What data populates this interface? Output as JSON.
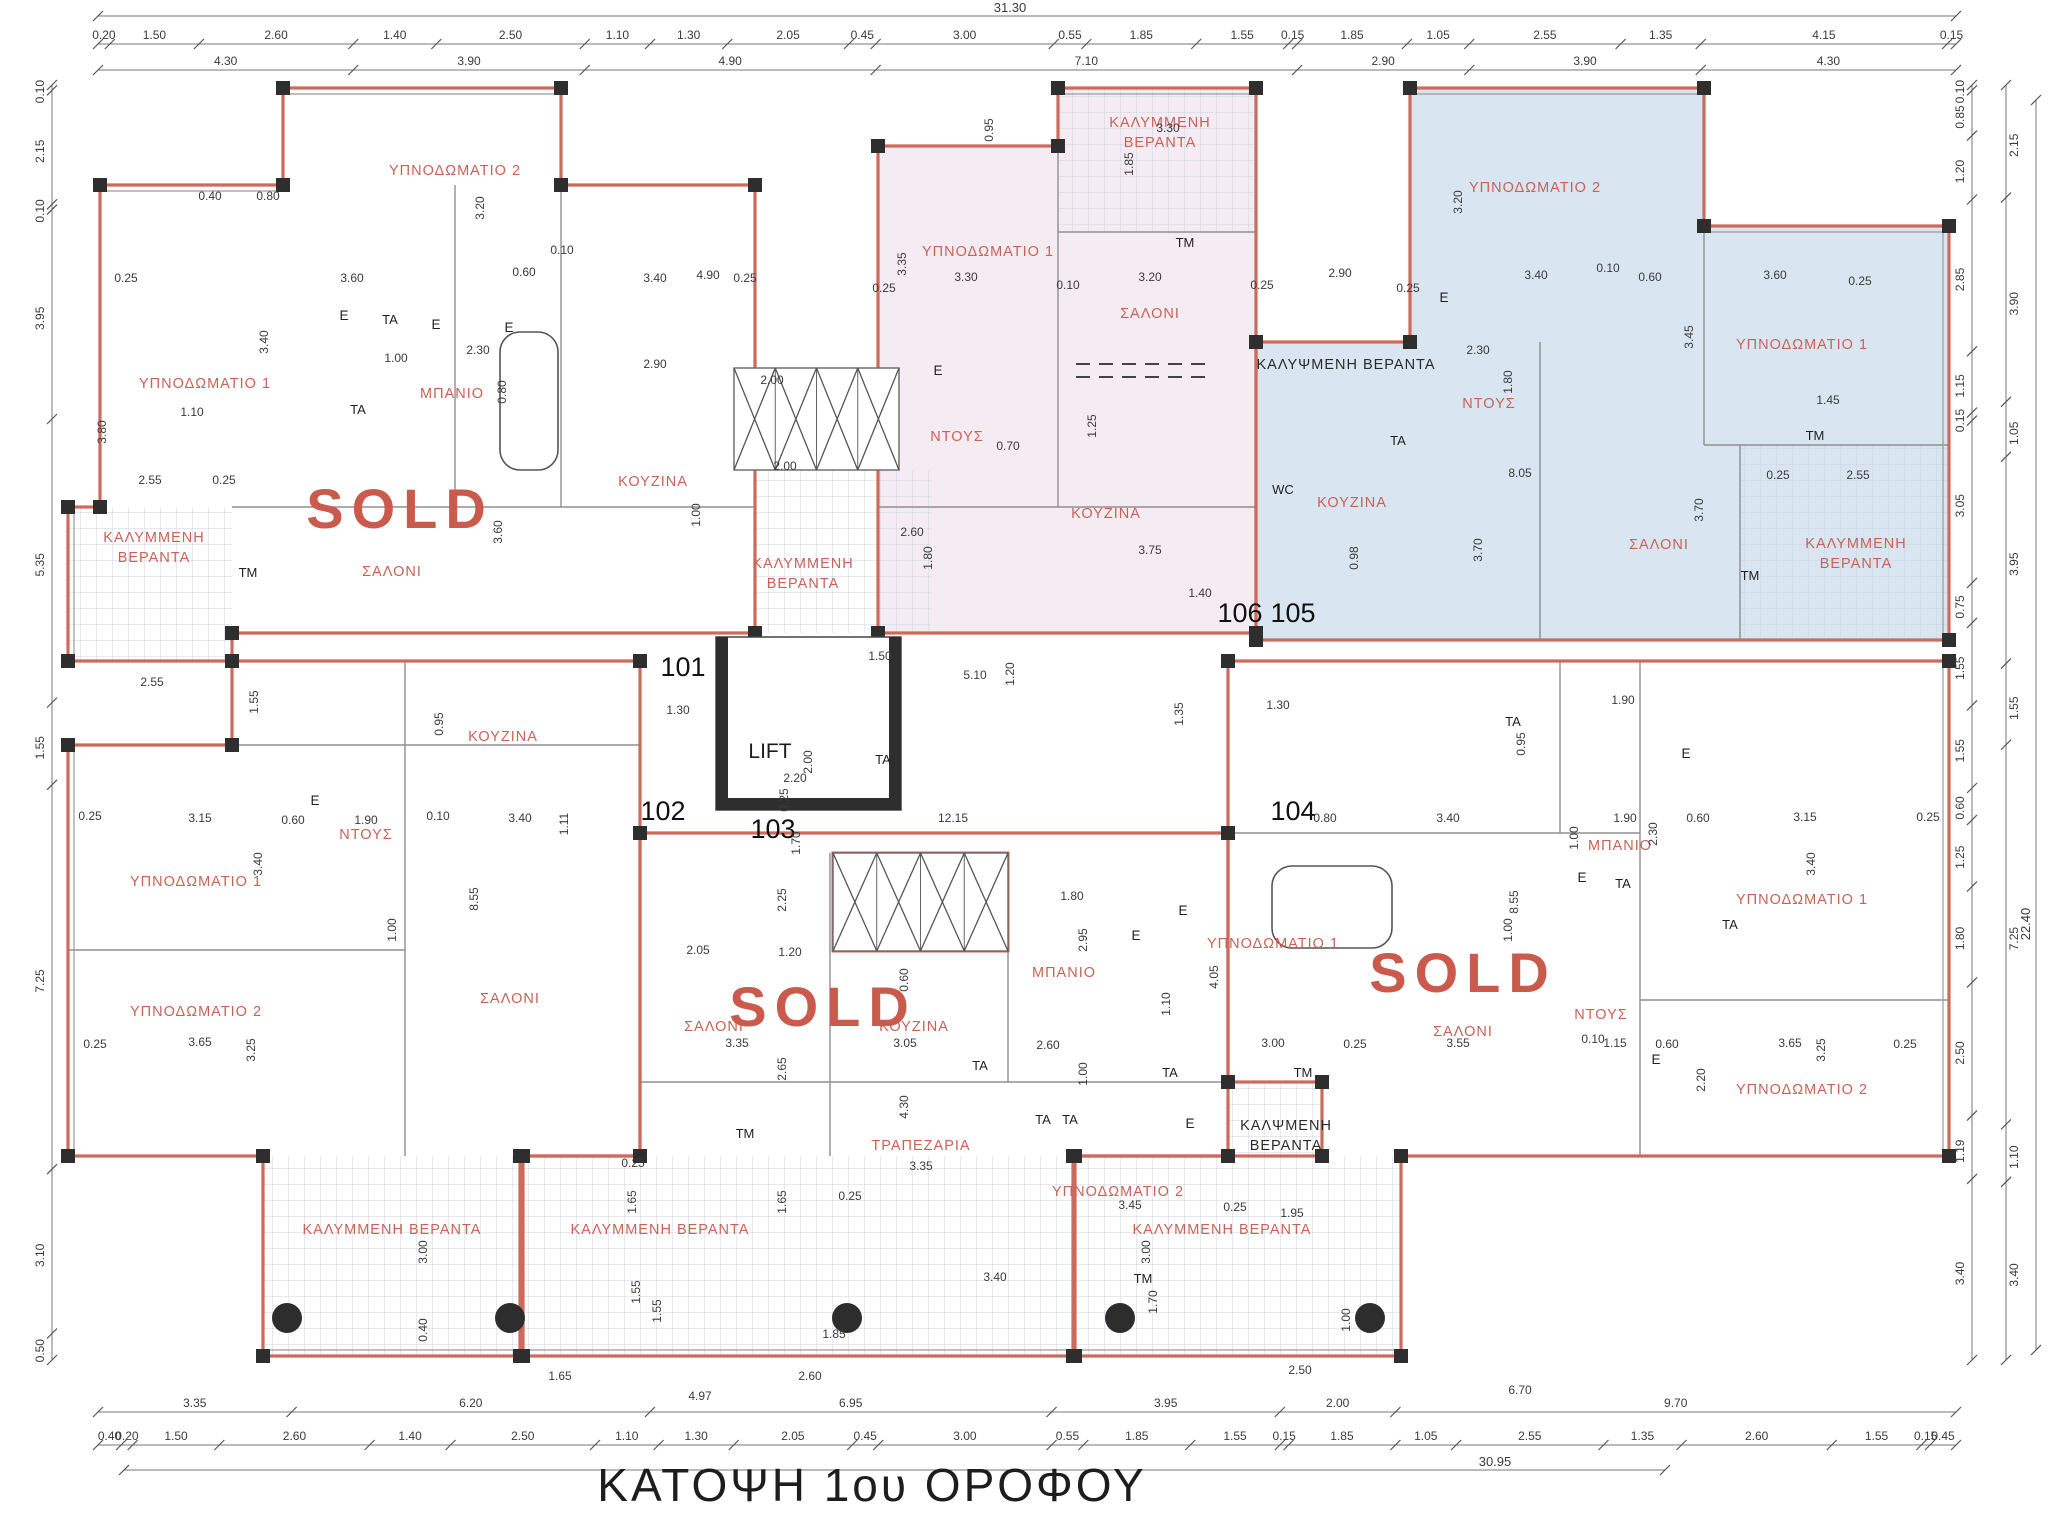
{
  "title": "ΚΑΤΟΨΗ 1ου ΟΡΟΦΟΥ",
  "sold_label": "SOLD",
  "lift_label": "LIFT",
  "colors": {
    "outline": "#cd6a5c",
    "room_text": "#c96256",
    "sold_text": "#c95a4c",
    "pink_fill": "#f5ecf3",
    "blue_fill": "#d9e6f2",
    "wall": "#2e2e2e",
    "dim_text": "#3a3a3a",
    "grid_line": "#ccd3de",
    "dark_text": "#2a2a2a"
  },
  "units": [
    {
      "number": "101",
      "x": 683,
      "y": 676
    },
    {
      "number": "102",
      "x": 663,
      "y": 820
    },
    {
      "number": "103",
      "x": 773,
      "y": 838
    },
    {
      "number": "104",
      "x": 1293,
      "y": 820
    },
    {
      "number": "105",
      "x": 1293,
      "y": 622
    },
    {
      "number": "106",
      "x": 1240,
      "y": 622
    }
  ],
  "sold_marks": [
    {
      "x": 400,
      "y": 528
    },
    {
      "x": 823,
      "y": 1026
    },
    {
      "x": 1463,
      "y": 992
    }
  ],
  "rooms": [
    {
      "t": [
        "ΥΠΝΟΔΩΜΑΤΙΟ 2"
      ],
      "x": 455,
      "y": 175
    },
    {
      "t": [
        "ΥΠΝΟΔΩΜΑΤΙΟ 1"
      ],
      "x": 205,
      "y": 388
    },
    {
      "t": [
        "ΚΑΛΥΜΜΕΝΗ",
        "ΒΕΡΑΝΤΑ"
      ],
      "x": 154,
      "y": 542
    },
    {
      "t": [
        "ΣΑΛΟΝΙ"
      ],
      "x": 392,
      "y": 576
    },
    {
      "t": [
        "ΜΠΑΝΙΟ"
      ],
      "x": 452,
      "y": 398
    },
    {
      "t": [
        "ΚΟΥΖΙΝΑ"
      ],
      "x": 653,
      "y": 486
    },
    {
      "t": [
        "ΚΑΛΥΜΜΕΝΗ",
        "ΒΕΡΑΝΤΑ"
      ],
      "x": 803,
      "y": 568
    },
    {
      "t": [
        "ΚΑΛΥΜΜΕΝΗ",
        "ΒΕΡΑΝΤΑ"
      ],
      "x": 1160,
      "y": 127
    },
    {
      "t": [
        "ΥΠΝΟΔΩΜΑΤΙΟ 1"
      ],
      "x": 988,
      "y": 256
    },
    {
      "t": [
        "ΣΑΛΟΝΙ"
      ],
      "x": 1150,
      "y": 318
    },
    {
      "t": [
        "ΝΤΟΥΣ"
      ],
      "x": 957,
      "y": 441
    },
    {
      "t": [
        "ΚΟΥΖΙΝΑ"
      ],
      "x": 1106,
      "y": 518
    },
    {
      "t": [
        "ΥΠΝΟΔΩΜΑΤΙΟ 2"
      ],
      "x": 1535,
      "y": 192
    },
    {
      "t": [
        "ΚΑΛΥΨΜΕΝΗ ΒΕΡΑΝΤΑ"
      ],
      "x": 1346,
      "y": 369,
      "c": "dark"
    },
    {
      "t": [
        "ΝΤΟΥΣ"
      ],
      "x": 1489,
      "y": 408
    },
    {
      "t": [
        "ΚΟΥΖΙΝΑ"
      ],
      "x": 1352,
      "y": 507
    },
    {
      "t": [
        "ΥΠΝΟΔΩΜΑΤΙΟ 1"
      ],
      "x": 1802,
      "y": 349
    },
    {
      "t": [
        "ΣΑΛΟΝΙ"
      ],
      "x": 1659,
      "y": 549
    },
    {
      "t": [
        "ΚΑΛΥΜΜΕΝΗ",
        "ΒΕΡΑΝΤΑ"
      ],
      "x": 1856,
      "y": 548
    },
    {
      "t": [
        "ΚΟΥΖΙΝΑ"
      ],
      "x": 503,
      "y": 741
    },
    {
      "t": [
        "ΥΠΝΟΔΩΜΑΤΙΟ 1"
      ],
      "x": 196,
      "y": 886
    },
    {
      "t": [
        "ΝΤΟΥΣ"
      ],
      "x": 366,
      "y": 839
    },
    {
      "t": [
        "ΥΠΝΟΔΩΜΑΤΙΟ 2"
      ],
      "x": 196,
      "y": 1016
    },
    {
      "t": [
        "ΣΑΛΟΝΙ"
      ],
      "x": 510,
      "y": 1003
    },
    {
      "t": [
        "ΚΑΛΥΜΜΕΝΗ ΒΕΡΑΝΤΑ"
      ],
      "x": 392,
      "y": 1234
    },
    {
      "t": [
        "ΣΑΛΟΝΙ"
      ],
      "x": 714,
      "y": 1031
    },
    {
      "t": [
        "ΚΟΥΖΙΝΑ"
      ],
      "x": 914,
      "y": 1031
    },
    {
      "t": [
        "ΜΠΑΝΙΟ"
      ],
      "x": 1064,
      "y": 977
    },
    {
      "t": [
        "ΤΡΑΠΕΖΑΡΙΑ"
      ],
      "x": 921,
      "y": 1150
    },
    {
      "t": [
        "ΥΠΝΟΔΩΜΑΤΙΟ 2"
      ],
      "x": 1118,
      "y": 1196
    },
    {
      "t": [
        "ΥΠΝΟΔΩΜΑΤΙΟ 1"
      ],
      "x": 1273,
      "y": 948
    },
    {
      "t": [
        "ΚΑΛΨΜΕΝΗ",
        "ΒΕΡΑΝΤΑ"
      ],
      "x": 1286,
      "y": 1130,
      "c": "dark"
    },
    {
      "t": [
        "ΚΑΛΥΜΜΕΝΗ ΒΕΡΑΝΤΑ"
      ],
      "x": 660,
      "y": 1234
    },
    {
      "t": [
        "ΚΑΛΥΜΜΕΝΗ ΒΕΡΑΝΤΑ"
      ],
      "x": 1222,
      "y": 1234
    },
    {
      "t": [
        "ΜΠΑΝΙΟ"
      ],
      "x": 1620,
      "y": 850
    },
    {
      "t": [
        "ΝΤΟΥΣ"
      ],
      "x": 1601,
      "y": 1019
    },
    {
      "t": [
        "ΥΠΝΟΔΩΜΑΤΙΟ 1"
      ],
      "x": 1802,
      "y": 904
    },
    {
      "t": [
        "ΥΠΝΟΔΩΜΑΤΙΟ 2"
      ],
      "x": 1802,
      "y": 1094
    },
    {
      "t": [
        "ΣΑΛΟΝΙ"
      ],
      "x": 1463,
      "y": 1036
    }
  ],
  "fixtures": [
    {
      "t": "TM",
      "x": 1185,
      "y": 247
    },
    {
      "t": "TM",
      "x": 1815,
      "y": 440
    },
    {
      "t": "TM",
      "x": 1750,
      "y": 580
    },
    {
      "t": "TM",
      "x": 248,
      "y": 577
    },
    {
      "t": "TM",
      "x": 745,
      "y": 1138
    },
    {
      "t": "TM",
      "x": 1303,
      "y": 1077
    },
    {
      "t": "TM",
      "x": 1143,
      "y": 1283
    },
    {
      "t": "TA",
      "x": 390,
      "y": 324
    },
    {
      "t": "TA",
      "x": 358,
      "y": 414
    },
    {
      "t": "TA",
      "x": 883,
      "y": 764
    },
    {
      "t": "TA",
      "x": 1398,
      "y": 445
    },
    {
      "t": "TA",
      "x": 1513,
      "y": 726
    },
    {
      "t": "TA",
      "x": 980,
      "y": 1070
    },
    {
      "t": "TA",
      "x": 1043,
      "y": 1124
    },
    {
      "t": "TA",
      "x": 1170,
      "y": 1077
    },
    {
      "t": "TA",
      "x": 1070,
      "y": 1124
    },
    {
      "t": "TA",
      "x": 1623,
      "y": 888
    },
    {
      "t": "TA",
      "x": 1730,
      "y": 929
    },
    {
      "t": "E",
      "x": 344,
      "y": 320
    },
    {
      "t": "E",
      "x": 436,
      "y": 329
    },
    {
      "t": "E",
      "x": 509,
      "y": 332
    },
    {
      "t": "E",
      "x": 938,
      "y": 375
    },
    {
      "t": "E",
      "x": 1444,
      "y": 302
    },
    {
      "t": "E",
      "x": 1686,
      "y": 758
    },
    {
      "t": "E",
      "x": 315,
      "y": 805
    },
    {
      "t": "E",
      "x": 1136,
      "y": 940
    },
    {
      "t": "E",
      "x": 1183,
      "y": 915
    },
    {
      "t": "E",
      "x": 1190,
      "y": 1128
    },
    {
      "t": "E",
      "x": 1582,
      "y": 882
    },
    {
      "t": "E",
      "x": 1656,
      "y": 1064
    },
    {
      "t": "WC",
      "x": 1283,
      "y": 494
    }
  ],
  "dims_inplan": [
    {
      "t": "0.40",
      "x": 210,
      "y": 200
    },
    {
      "t": "0.80",
      "x": 268,
      "y": 200
    },
    {
      "t": "0.25",
      "x": 126,
      "y": 282
    },
    {
      "t": "3.60",
      "x": 352,
      "y": 282
    },
    {
      "t": "0.60",
      "x": 524,
      "y": 276
    },
    {
      "t": "0.10",
      "x": 562,
      "y": 254
    },
    {
      "t": "3.40",
      "x": 655,
      "y": 282
    },
    {
      "t": "0.25",
      "x": 745,
      "y": 282
    },
    {
      "t": "3.20",
      "x": 484,
      "y": 208,
      "r": 90
    },
    {
      "t": "3.40",
      "x": 268,
      "y": 342,
      "r": 90
    },
    {
      "t": "1.10",
      "x": 192,
      "y": 416
    },
    {
      "t": "2.55",
      "x": 150,
      "y": 484
    },
    {
      "t": "0.25",
      "x": 224,
      "y": 484
    },
    {
      "t": "1.00",
      "x": 396,
      "y": 362
    },
    {
      "t": "2.30",
      "x": 478,
      "y": 354
    },
    {
      "t": "0.80",
      "x": 506,
      "y": 392,
      "r": 90
    },
    {
      "t": "3.80",
      "x": 106,
      "y": 432,
      "r": 90
    },
    {
      "t": "3.60",
      "x": 502,
      "y": 532,
      "r": 90
    },
    {
      "t": "4.90",
      "x": 708,
      "y": 279
    },
    {
      "t": "2.90",
      "x": 655,
      "y": 368
    },
    {
      "t": "2.00",
      "x": 772,
      "y": 384
    },
    {
      "t": "2.00",
      "x": 785,
      "y": 470
    },
    {
      "t": "1.00",
      "x": 700,
      "y": 515,
      "r": 90
    },
    {
      "t": "2.60",
      "x": 912,
      "y": 536
    },
    {
      "t": "1.80",
      "x": 932,
      "y": 558,
      "r": 90
    },
    {
      "t": "0.95",
      "x": 993,
      "y": 130,
      "r": 90
    },
    {
      "t": "3.30",
      "x": 1168,
      "y": 132
    },
    {
      "t": "1.85",
      "x": 1133,
      "y": 164,
      "r": 90
    },
    {
      "t": "3.35",
      "x": 906,
      "y": 264,
      "r": 90
    },
    {
      "t": "3.30",
      "x": 966,
      "y": 281
    },
    {
      "t": "0.10",
      "x": 1068,
      "y": 289
    },
    {
      "t": "3.20",
      "x": 1150,
      "y": 281
    },
    {
      "t": "0.25",
      "x": 884,
      "y": 292
    },
    {
      "t": "0.25",
      "x": 1262,
      "y": 289
    },
    {
      "t": "1.25",
      "x": 1096,
      "y": 426,
      "r": 90
    },
    {
      "t": "0.70",
      "x": 1008,
      "y": 450
    },
    {
      "t": "2.90",
      "x": 1340,
      "y": 277
    },
    {
      "t": "0.25",
      "x": 1408,
      "y": 292
    },
    {
      "t": "3.40",
      "x": 1536,
      "y": 279
    },
    {
      "t": "0.10",
      "x": 1608,
      "y": 272
    },
    {
      "t": "0.60",
      "x": 1650,
      "y": 281
    },
    {
      "t": "3.60",
      "x": 1775,
      "y": 279
    },
    {
      "t": "0.25",
      "x": 1860,
      "y": 285
    },
    {
      "t": "3.20",
      "x": 1462,
      "y": 202,
      "r": 90
    },
    {
      "t": "3.45",
      "x": 1693,
      "y": 337,
      "r": 90
    },
    {
      "t": "1.45",
      "x": 1828,
      "y": 404
    },
    {
      "t": "2.30",
      "x": 1478,
      "y": 354
    },
    {
      "t": "1.80",
      "x": 1512,
      "y": 382,
      "r": 90
    },
    {
      "t": "8.05",
      "x": 1520,
      "y": 477
    },
    {
      "t": "3.70",
      "x": 1482,
      "y": 550,
      "r": 90
    },
    {
      "t": "0.98",
      "x": 1358,
      "y": 558,
      "r": 90
    },
    {
      "t": "3.70",
      "x": 1703,
      "y": 510,
      "r": 90
    },
    {
      "t": "3.75",
      "x": 1150,
      "y": 554
    },
    {
      "t": "1.40",
      "x": 1200,
      "y": 597
    },
    {
      "t": "2.55",
      "x": 1858,
      "y": 479
    },
    {
      "t": "0.25",
      "x": 1778,
      "y": 479
    },
    {
      "t": "1.50",
      "x": 880,
      "y": 660
    },
    {
      "t": "5.10",
      "x": 975,
      "y": 679
    },
    {
      "t": "1.20",
      "x": 1014,
      "y": 674,
      "r": 90
    },
    {
      "t": "1.30",
      "x": 678,
      "y": 714
    },
    {
      "t": "12.15",
      "x": 953,
      "y": 822
    },
    {
      "t": "2.20",
      "x": 795,
      "y": 782
    },
    {
      "t": "2.00",
      "x": 812,
      "y": 762,
      "r": 90
    },
    {
      "t": "1.35",
      "x": 1183,
      "y": 714,
      "r": 90
    },
    {
      "t": "1.30",
      "x": 1278,
      "y": 709
    },
    {
      "t": "1.70",
      "x": 800,
      "y": 843,
      "r": 90
    },
    {
      "t": "0.25",
      "x": 788,
      "y": 800,
      "r": 90
    },
    {
      "t": "1.90",
      "x": 1623,
      "y": 704
    },
    {
      "t": "0.95",
      "x": 1525,
      "y": 744,
      "r": 90
    },
    {
      "t": "2.55",
      "x": 152,
      "y": 686
    },
    {
      "t": "1.55",
      "x": 258,
      "y": 702,
      "r": 90
    },
    {
      "t": "0.95",
      "x": 443,
      "y": 724,
      "r": 90
    },
    {
      "t": "0.25",
      "x": 90,
      "y": 820
    },
    {
      "t": "3.15",
      "x": 200,
      "y": 822
    },
    {
      "t": "0.60",
      "x": 293,
      "y": 824
    },
    {
      "t": "1.90",
      "x": 366,
      "y": 824
    },
    {
      "t": "0.10",
      "x": 438,
      "y": 820
    },
    {
      "t": "3.40",
      "x": 520,
      "y": 822
    },
    {
      "t": "1.11",
      "x": 568,
      "y": 824,
      "r": 90
    },
    {
      "t": "3.40",
      "x": 262,
      "y": 864,
      "r": 90
    },
    {
      "t": "8.55",
      "x": 478,
      "y": 899,
      "r": 90
    },
    {
      "t": "1.00",
      "x": 396,
      "y": 930,
      "r": 90
    },
    {
      "t": "3.65",
      "x": 200,
      "y": 1046
    },
    {
      "t": "0.25",
      "x": 95,
      "y": 1048
    },
    {
      "t": "3.25",
      "x": 255,
      "y": 1050,
      "r": 90
    },
    {
      "t": "2.05",
      "x": 698,
      "y": 954
    },
    {
      "t": "1.20",
      "x": 790,
      "y": 956
    },
    {
      "t": "2.25",
      "x": 786,
      "y": 900,
      "r": 90
    },
    {
      "t": "3.35",
      "x": 737,
      "y": 1047
    },
    {
      "t": "2.65",
      "x": 786,
      "y": 1069,
      "r": 90
    },
    {
      "t": "3.05",
      "x": 905,
      "y": 1047
    },
    {
      "t": "0.60",
      "x": 908,
      "y": 980,
      "r": 90
    },
    {
      "t": "1.80",
      "x": 1072,
      "y": 900
    },
    {
      "t": "2.95",
      "x": 1087,
      "y": 940,
      "r": 90
    },
    {
      "t": "2.60",
      "x": 1048,
      "y": 1049
    },
    {
      "t": "1.00",
      "x": 1087,
      "y": 1074,
      "r": 90
    },
    {
      "t": "4.30",
      "x": 908,
      "y": 1107,
      "r": 90
    },
    {
      "t": "3.35",
      "x": 921,
      "y": 1170
    },
    {
      "t": "1.65",
      "x": 786,
      "y": 1202,
      "r": 90
    },
    {
      "t": "0.25",
      "x": 850,
      "y": 1200
    },
    {
      "t": "4.05",
      "x": 1218,
      "y": 977,
      "r": 90
    },
    {
      "t": "1.10",
      "x": 1170,
      "y": 1004,
      "r": 90
    },
    {
      "t": "3.00",
      "x": 1273,
      "y": 1047
    },
    {
      "t": "0.25",
      "x": 1355,
      "y": 1048
    },
    {
      "t": "0.80",
      "x": 1325,
      "y": 822
    },
    {
      "t": "3.40",
      "x": 1448,
      "y": 822
    },
    {
      "t": "3.55",
      "x": 1458,
      "y": 1047
    },
    {
      "t": "8.55",
      "x": 1518,
      "y": 902,
      "r": 90
    },
    {
      "t": "1.00",
      "x": 1512,
      "y": 930,
      "r": 90
    },
    {
      "t": "1.95",
      "x": 1292,
      "y": 1217
    },
    {
      "t": "3.45",
      "x": 1130,
      "y": 1209
    },
    {
      "t": "0.25",
      "x": 1235,
      "y": 1211
    },
    {
      "t": "1.90",
      "x": 1625,
      "y": 822
    },
    {
      "t": "0.60",
      "x": 1698,
      "y": 822
    },
    {
      "t": "2.30",
      "x": 1657,
      "y": 834,
      "r": 90
    },
    {
      "t": "3.15",
      "x": 1805,
      "y": 821
    },
    {
      "t": "0.25",
      "x": 1928,
      "y": 821
    },
    {
      "t": "3.40",
      "x": 1815,
      "y": 864,
      "r": 90
    },
    {
      "t": "1.00",
      "x": 1578,
      "y": 838,
      "r": 90
    },
    {
      "t": "1.15",
      "x": 1615,
      "y": 1047
    },
    {
      "t": "0.60",
      "x": 1667,
      "y": 1048
    },
    {
      "t": "0.10",
      "x": 1593,
      "y": 1043
    },
    {
      "t": "2.20",
      "x": 1705,
      "y": 1080,
      "r": 90
    },
    {
      "t": "3.65",
      "x": 1790,
      "y": 1047
    },
    {
      "t": "3.25",
      "x": 1825,
      "y": 1050,
      "r": 90
    },
    {
      "t": "0.25",
      "x": 1905,
      "y": 1048
    },
    {
      "t": "1.65",
      "x": 560,
      "y": 1380
    },
    {
      "t": "2.60",
      "x": 810,
      "y": 1380
    },
    {
      "t": "4.97",
      "x": 700,
      "y": 1400
    },
    {
      "t": "2.50",
      "x": 1300,
      "y": 1374
    },
    {
      "t": "6.70",
      "x": 1520,
      "y": 1394
    },
    {
      "t": "3.00",
      "x": 427,
      "y": 1252,
      "r": 90
    },
    {
      "t": "0.40",
      "x": 427,
      "y": 1330,
      "r": 90
    },
    {
      "t": "1.55",
      "x": 640,
      "y": 1292,
      "r": 90
    },
    {
      "t": "1.65",
      "x": 636,
      "y": 1202,
      "r": 90
    },
    {
      "t": "0.25",
      "x": 633,
      "y": 1167
    },
    {
      "t": "3.00",
      "x": 1150,
      "y": 1252,
      "r": 90
    },
    {
      "t": "1.00",
      "x": 1350,
      "y": 1320,
      "r": 90
    },
    {
      "t": "3.40",
      "x": 995,
      "y": 1281
    },
    {
      "t": "1.85",
      "x": 834,
      "y": 1338
    },
    {
      "t": "1.55",
      "x": 661,
      "y": 1311,
      "r": 90
    },
    {
      "t": "1.70",
      "x": 1157,
      "y": 1302,
      "r": 90
    }
  ],
  "dim_chains": {
    "top_total": "31.30",
    "top_segments": [
      "0.20",
      "1.50",
      "2.60",
      "1.40",
      "2.50",
      "1.10",
      "1.30",
      "2.05",
      "0.45",
      "3.00",
      "0.55",
      "1.85",
      "1.55",
      "0.15",
      "1.85",
      "1.05",
      "2.55",
      "1.35",
      "4.15",
      "0.15"
    ],
    "top_groups": [
      "4.30",
      "3.90",
      "4.90",
      "7.10",
      "2.90",
      "3.90",
      "4.30"
    ],
    "bottom_groups": [
      "3.35",
      "6.20",
      "6.95",
      "3.95",
      "2.00",
      "9.70"
    ],
    "bottom_segments": [
      "0.40",
      "0.20",
      "1.50",
      "2.60",
      "1.40",
      "2.50",
      "1.10",
      "1.30",
      "2.05",
      "0.45",
      "3.00",
      "0.55",
      "1.85",
      "1.55",
      "0.15",
      "1.85",
      "1.05",
      "2.55",
      "1.35",
      "2.60",
      "1.55",
      "0.15",
      "0.45"
    ],
    "bottom_total": "30.95",
    "left": [
      "0.10",
      "2.15",
      "0.10",
      "3.95",
      "5.35",
      "1.55",
      "7.25",
      "3.10",
      "0.50"
    ],
    "right_inner": [
      "0.10",
      "0.85",
      "1.20",
      "2.85",
      "1.15",
      "0.15",
      "3.05",
      "0.75",
      "1.55",
      "1.55",
      "0.60",
      "1.25",
      "1.80",
      "2.50",
      "1.19",
      "3.40"
    ],
    "right_outer": [
      "2.15",
      "3.90",
      "1.05",
      "3.95",
      "1.55",
      "7.25",
      "1.10",
      "3.40"
    ],
    "right_total": "22.40"
  }
}
